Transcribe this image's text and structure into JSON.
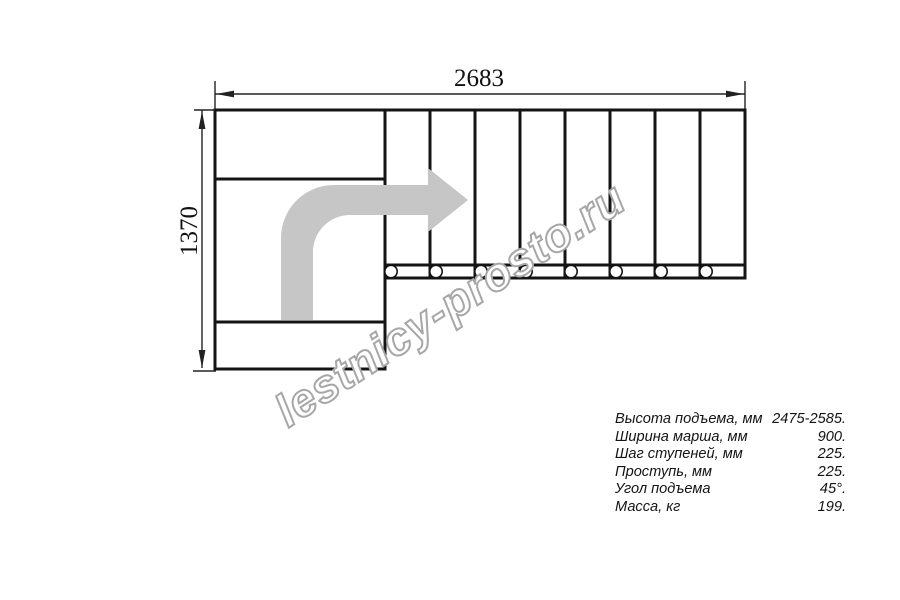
{
  "drawing": {
    "top_dimension": "2683",
    "left_dimension": "1370"
  },
  "watermark": {
    "text": "lestnicy-prosto.ru",
    "outline_color": "#a7a7a7"
  },
  "specs": {
    "rows": [
      {
        "label": "Высота подъема, мм",
        "value": "2475-2585."
      },
      {
        "label": "Ширина марша, мм",
        "value": "900."
      },
      {
        "label": "Шаг ступеней, мм",
        "value": "225."
      },
      {
        "label": "Проступь, мм",
        "value": "225."
      },
      {
        "label": "Угол подъема",
        "value": "45°."
      },
      {
        "label": "Масса, кг",
        "value": "199."
      }
    ]
  },
  "colors": {
    "line": "#141414",
    "direction_arrow": "#c6c6c6",
    "watermark_outline": "#a7a7a7",
    "background": "#ffffff"
  }
}
